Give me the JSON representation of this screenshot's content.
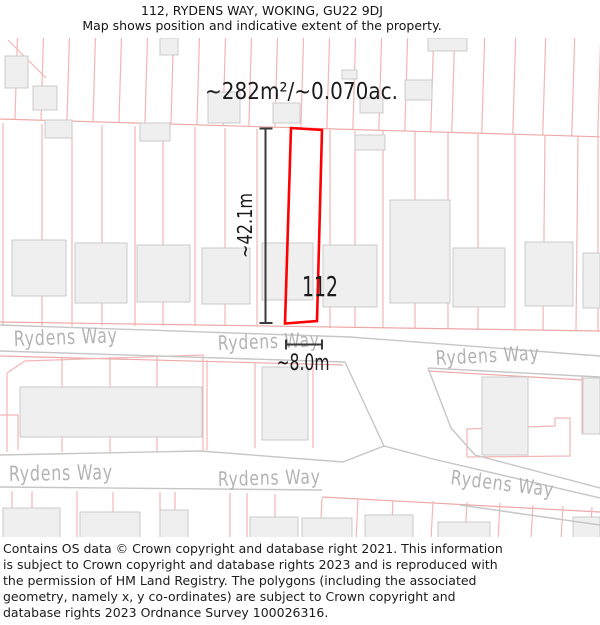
{
  "header": {
    "title": "112, RYDENS WAY, WOKING, GU22 9DJ",
    "subtitle": "Map shows position and indicative extent of the property."
  },
  "map": {
    "area_label": "~282m²/~0.070ac.",
    "plot_number": "112",
    "plot_length_label": "~42.1m",
    "plot_width_label": "~8.0m",
    "street_labels": [
      "Rydens Way",
      "Rydens Way",
      "Rydens Way",
      "Rydens Way",
      "Rydens Way",
      "Rydens Way"
    ],
    "colors": {
      "plot_outline": "#ff0000",
      "parcel_line": "#f3b6b6",
      "road_edge": "#c6c6c6",
      "building_fill": "#f0efef",
      "building_stroke": "#cbcbcb",
      "street_label": "#b3b3b3",
      "measurement": "#3a3a3a"
    }
  },
  "footer": {
    "text": "Contains OS data © Crown copyright and database right 2021. This information is subject to Crown copyright and database rights 2023 and is reproduced with the permission of HM Land Registry. The polygons (including the associated geometry, namely x, y co-ordinates) are subject to Crown copyright and database rights 2023 Ordnance Survey 100026316."
  }
}
